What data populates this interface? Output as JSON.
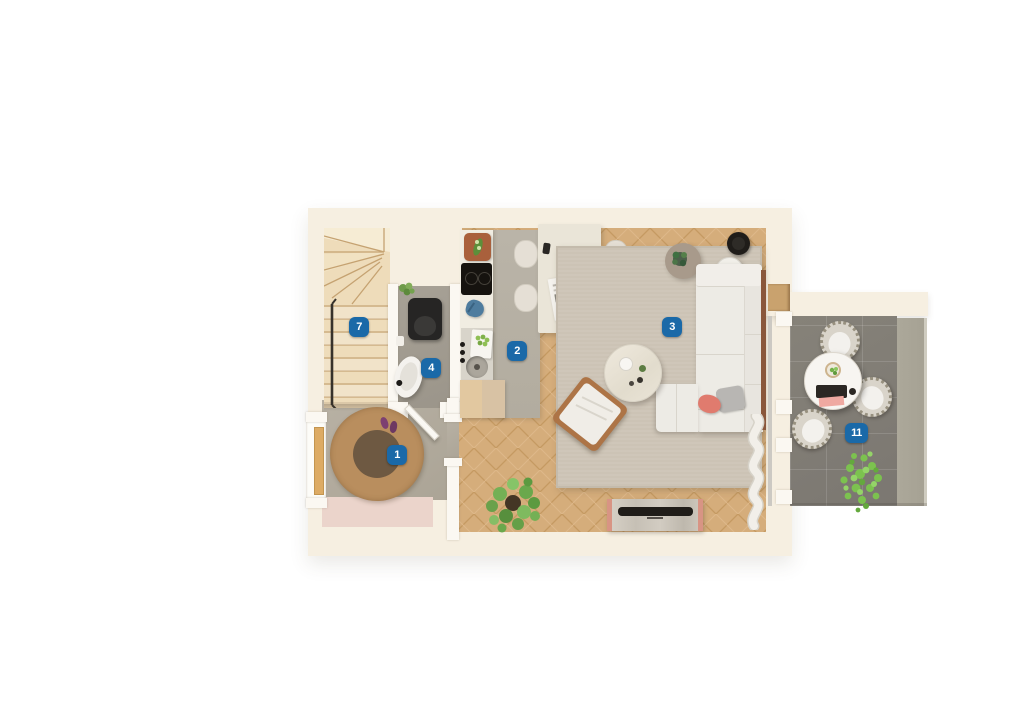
{
  "page": {
    "background_color": "#ffffff",
    "description": "Top-down 3D rendered apartment floor plan with numbered room markers"
  },
  "floor_plan": {
    "room_badges": [
      {
        "label": "1",
        "room": "entry-hall"
      },
      {
        "label": "2",
        "room": "kitchen"
      },
      {
        "label": "3",
        "room": "living-room"
      },
      {
        "label": "4",
        "room": "bathroom"
      },
      {
        "label": "7",
        "room": "staircase"
      },
      {
        "label": "11",
        "room": "terrace"
      }
    ],
    "badge_style": {
      "background_color": "#1a69a8",
      "text_color": "#ffffff"
    },
    "palette": {
      "wall_outer": "#f6efe1",
      "wall_inner": "#fbf8f2",
      "wood_floor": "#d3a975",
      "kitchen_floor": "#b6b0a4",
      "bathroom_floor": "#a39d92",
      "hall_floor": "#b3ac9f",
      "living_rug": "#ccc3b5",
      "hall_rug_outer": "#b98e5e",
      "hall_rug_inner": "#6e5942",
      "terrace_tile": "#817d78",
      "terrace_strip": "#aaa79b",
      "sofa": "#edebe5",
      "stairs_wood": "#eedcba",
      "accent_throw_yellow": "#e9a23e",
      "accent_mat_pink": "#ebd4cb",
      "accent_pillow_pink": "#e07b6e",
      "plant_green": "#6da84e"
    }
  }
}
